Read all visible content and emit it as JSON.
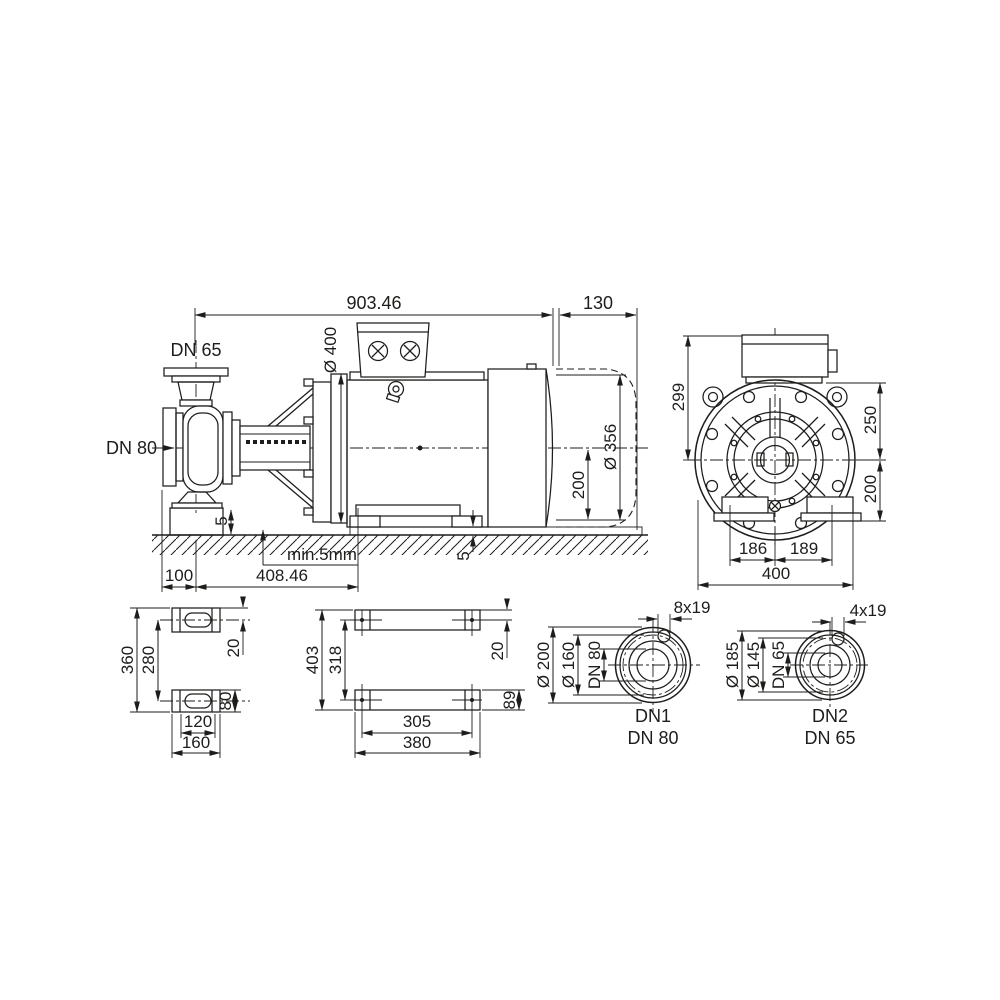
{
  "colors": {
    "line": "#1d1d1b",
    "background": "#ffffff"
  },
  "drawing": {
    "side": {
      "total_length": "903.46",
      "rear_length": "130",
      "suction": "DN 65",
      "discharge": "DN 80",
      "flange_dia": "Ø 400",
      "motor_dia": "Ø 356",
      "shaft_height": "200",
      "pump_shim": "5",
      "motor_shim": "5",
      "grout_note": "min.5mm",
      "foot_offset": "100",
      "feet_span": "408.46"
    },
    "front": {
      "overall_height": "299",
      "upper": "250",
      "lower": "200",
      "foot_left": "186",
      "foot_right": "189",
      "width": "400"
    },
    "pump_feet": {
      "length": "360",
      "pitch": "280",
      "slot": "20",
      "width": "80",
      "pitch_w": "120",
      "foot_len": "160"
    },
    "motor_feet": {
      "length": "403",
      "pitch": "318",
      "offset": "20",
      "width": "89",
      "pitch_w": "305",
      "rail_len": "380"
    },
    "dn1": {
      "holes": "8x19",
      "outer": "Ø 200",
      "bolt_circle": "Ø 160",
      "bore": "DN 80",
      "name": "DN1",
      "size": "DN 80"
    },
    "dn2": {
      "holes": "4x19",
      "outer": "Ø 185",
      "bolt_circle": "Ø 145",
      "bore": "DN 65",
      "name": "DN2",
      "size": "DN 65"
    }
  }
}
